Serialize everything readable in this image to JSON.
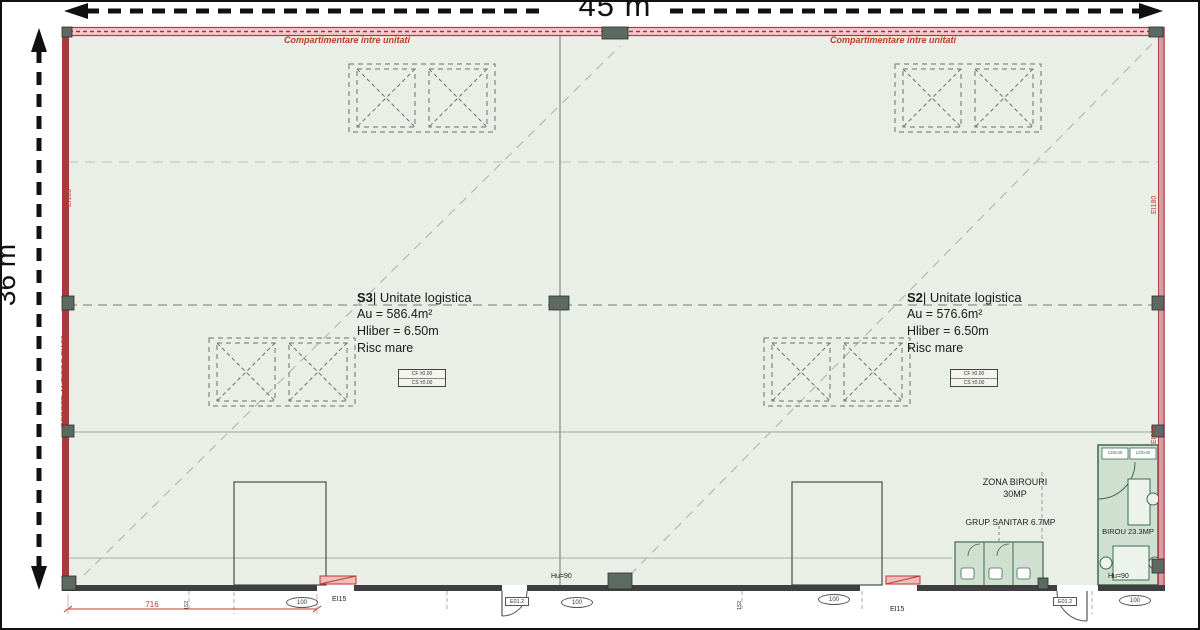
{
  "dimensions": {
    "width_label": "45 m",
    "height_label": "36 m"
  },
  "wall_labels": {
    "compartimentare_left": "Compartimentare intre unitati",
    "compartimentare_right": "Compartimentare intre unitati",
    "perete_antifoc": "PERETE ANTIFOC EI180",
    "ei180_left": "EI180",
    "ei180_right_top": "EI180",
    "ei180_right_mid": "EI180"
  },
  "units": [
    {
      "id": "S3",
      "name": "| Unitate logistica",
      "area": "Au = 586.4m²",
      "clear_height": "Hliber = 6.50m",
      "risk": "Risc mare",
      "level_line1": "CF ±0.00",
      "level_line2": "CS ±0.00"
    },
    {
      "id": "S2",
      "name": "| Unitate logistica",
      "area": "Au = 576.6m²",
      "clear_height": "Hliber = 6.50m",
      "risk": "Risc mare",
      "level_line1": "CF ±0.00",
      "level_line2": "CS ±0.00"
    }
  ],
  "office": {
    "zona_line1": "ZONA BIROURI",
    "zona_line2": "30MP",
    "grup_sanitar": "GRUP SANITAR 6.7MP",
    "birou": "BIROU 23.3MP",
    "cabinet1": "120x40",
    "cabinet2": "120x40"
  },
  "annotations": {
    "door_height_center": "Hu=90",
    "door_height_office": "Hu=90",
    "fire_door_left": "EI15",
    "fire_door_right": "EI15",
    "oval1": "100",
    "oval2": "100",
    "oval3": "100",
    "oval4": "100",
    "door_tag_center": "E01.2",
    "door_tag_office": "E01.2",
    "dim_716": "716",
    "dim_152_a": "152",
    "dim_152_b": "152"
  },
  "colors": {
    "interior": "#e9eee7",
    "wall_dark_red": "#a43c3c",
    "wall_pink": "#f0cdd1",
    "green_room": "#cfe0d0",
    "annotation_red": "#c0392b"
  }
}
